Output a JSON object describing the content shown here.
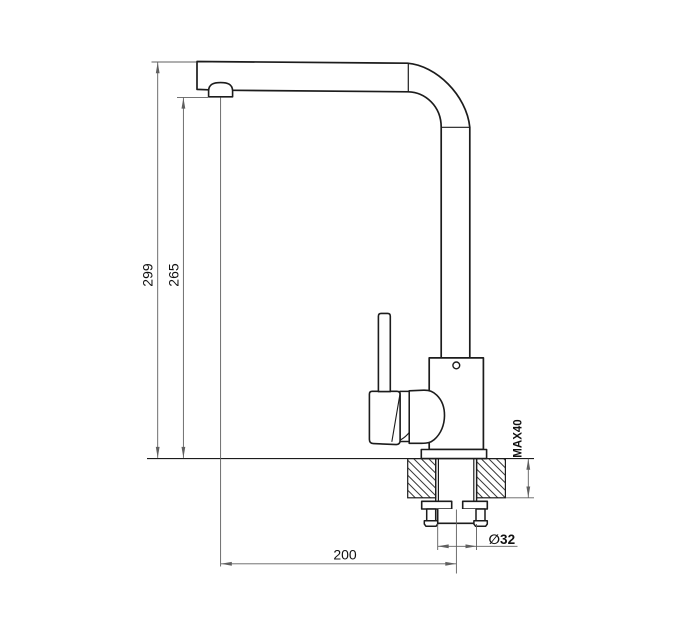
{
  "window": {
    "width": 680,
    "height": 630,
    "background": "#ffffff"
  },
  "drawing": {
    "colors": {
      "outline": "#1c1c1c",
      "dimension": "#5f5f5f",
      "text": "#111111",
      "hatch": "#3a3a3a"
    },
    "labels": {
      "total_height": "299",
      "outlet_height": "265",
      "spout_reach": "200",
      "max_counter_thickness": "MAX40",
      "hole_diameter": "∅32"
    }
  }
}
